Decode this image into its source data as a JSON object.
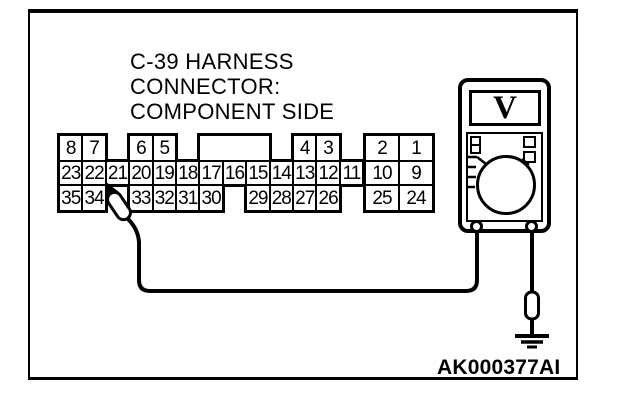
{
  "colors": {
    "ink": "#000000",
    "paper": "#ffffff"
  },
  "title": {
    "lines": [
      "C-39 HARNESS",
      "CONNECTOR:",
      "COMPONENT SIDE"
    ]
  },
  "figure_code": "AK000377AI",
  "multimeter": {
    "display_symbol": "V",
    "kind": "voltmeter"
  },
  "probe": {
    "points_to_pin": "22"
  },
  "connector": {
    "name": "C-39",
    "rows": [
      {
        "name": "top",
        "cells": [
          {
            "label": "8",
            "col": 0
          },
          {
            "label": "7",
            "col": 1
          },
          {
            "label": "6",
            "col": 3
          },
          {
            "label": "5",
            "col": 4
          },
          {
            "label": "",
            "col": 6,
            "span": 3
          },
          {
            "label": "4",
            "col": 10
          },
          {
            "label": "3",
            "col": 11
          },
          {
            "label": "2",
            "col": 0,
            "block": "right"
          },
          {
            "label": "1",
            "col": 1,
            "block": "right"
          }
        ]
      },
      {
        "name": "middle",
        "cells": [
          {
            "label": "23",
            "col": 0
          },
          {
            "label": "22",
            "col": 1
          },
          {
            "label": "21",
            "col": 2
          },
          {
            "label": "20",
            "col": 3
          },
          {
            "label": "19",
            "col": 4
          },
          {
            "label": "18",
            "col": 5
          },
          {
            "label": "17",
            "col": 6
          },
          {
            "label": "16",
            "col": 7
          },
          {
            "label": "15",
            "col": 8
          },
          {
            "label": "14",
            "col": 9
          },
          {
            "label": "13",
            "col": 10
          },
          {
            "label": "12",
            "col": 11
          },
          {
            "label": "11",
            "col": 12
          },
          {
            "label": "10",
            "col": 0,
            "block": "right"
          },
          {
            "label": "9",
            "col": 1,
            "block": "right"
          }
        ]
      },
      {
        "name": "bottom",
        "cells": [
          {
            "label": "35",
            "col": 0
          },
          {
            "label": "34",
            "col": 1
          },
          {
            "label": "33",
            "col": 3
          },
          {
            "label": "32",
            "col": 4
          },
          {
            "label": "31",
            "col": 5
          },
          {
            "label": "30",
            "col": 6
          },
          {
            "label": "29",
            "col": 8
          },
          {
            "label": "28",
            "col": 9
          },
          {
            "label": "27",
            "col": 10
          },
          {
            "label": "26",
            "col": 11
          },
          {
            "label": "25",
            "col": 0,
            "block": "right"
          },
          {
            "label": "24",
            "col": 1,
            "block": "right"
          }
        ]
      }
    ]
  }
}
